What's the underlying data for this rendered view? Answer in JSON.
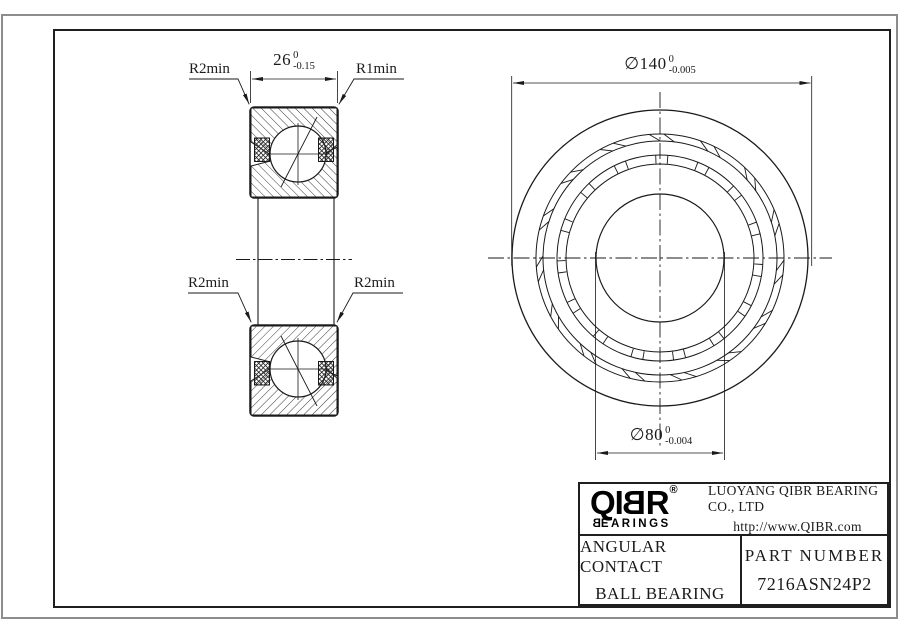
{
  "drawing": {
    "dimensions": {
      "width": {
        "value": "26",
        "tol_upper": "0",
        "tol_lower": "-0.15"
      },
      "outer_diameter": {
        "symbol": "∅",
        "value": "140",
        "tol_upper": "0",
        "tol_lower": "-0.005"
      },
      "bore_diameter": {
        "symbol": "∅",
        "value": "80",
        "tol_upper": "0",
        "tol_lower": "-0.004"
      }
    },
    "labels": {
      "radius_top_left": "R2min",
      "radius_top_right": "R1min",
      "radius_bottom_left": "R2min",
      "radius_bottom_right": "R2min"
    }
  },
  "title_block": {
    "logo": {
      "part1": "QI",
      "part_mirrored": "B",
      "part2": "R",
      "registered": "®",
      "brand_mirrored": "B",
      "brand_rest": "EARINGS"
    },
    "company": "LUOYANG QIBR BEARING CO., LTD",
    "website": "http://www.QIBR.com",
    "product_type_line1": "ANGULAR CONTACT",
    "product_type_line2": "BALL BEARING",
    "part_number_label": "PART NUMBER",
    "part_number": "7216ASN24P2"
  },
  "colors": {
    "line": "#1a1a1a",
    "frame_outer": "#8d8d8d",
    "background": "#ffffff"
  }
}
